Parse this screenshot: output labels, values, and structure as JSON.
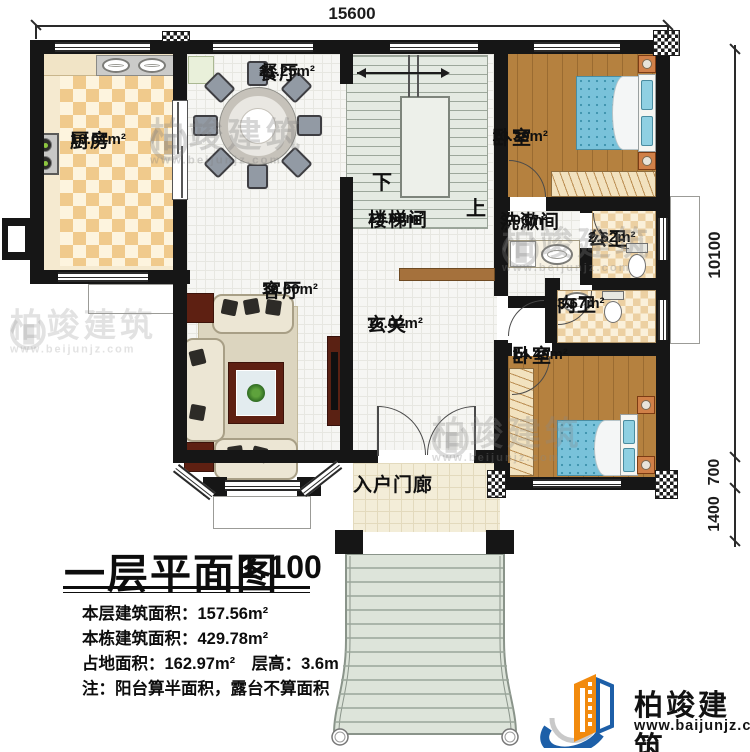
{
  "dimensions": {
    "top_width": "15600",
    "right_depth": "10100",
    "right_porch": "700",
    "right_steps": "1400"
  },
  "rooms": [
    {
      "name": "厨房",
      "area": "18.01m²"
    },
    {
      "name": "餐厅",
      "area": "21.25m²"
    },
    {
      "name": "卧室",
      "area": "13.39m²"
    },
    {
      "name": "楼梯间",
      "area": "19.08m²"
    },
    {
      "name": "洗漱间",
      "area": "3.06m²"
    },
    {
      "name": "公卫",
      "area": "2.62m²"
    },
    {
      "name": "内卫",
      "area": "3.67m²"
    },
    {
      "name": "客厅",
      "area": "19.60m²"
    },
    {
      "name": "玄关",
      "area": "16.02m²"
    },
    {
      "name": "卧室",
      "area": "14.49m²"
    },
    {
      "name": "入户门廊",
      "area": ""
    }
  ],
  "stairs": {
    "down": "下",
    "up": "上"
  },
  "title_block": {
    "title": "一层平面图",
    "scale": "1:100",
    "line1": "本层建筑面积：157.56m²",
    "line2": "本栋建筑面积：429.78m²",
    "line3": "占地面积：162.97m²　层高：3.6m",
    "line4": "注：阳台算半面积，露台不算面积"
  },
  "logo": {
    "name": "柏竣建筑",
    "site": "www.baijunjz.com"
  },
  "watermark": {
    "name": "柏竣建筑",
    "site": "www.beijunjz.com"
  },
  "colors": {
    "logo_orange": "#f28a0d",
    "logo_blue": "#1d5fa8",
    "wall": "#161616"
  }
}
